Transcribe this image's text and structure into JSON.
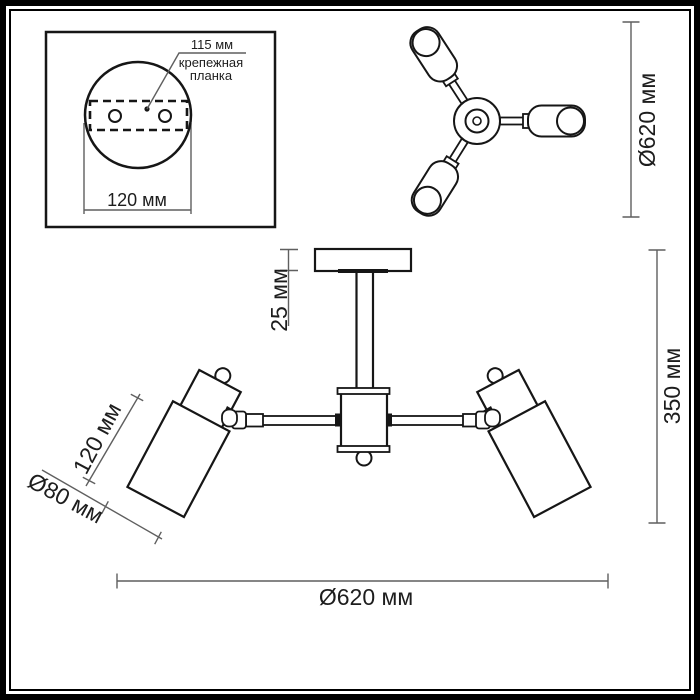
{
  "drawing": {
    "kind": "ceiling-lamp-dimension-drawing",
    "units": "мм"
  },
  "inset": {
    "plate_width_label": "115 мм",
    "plate_name_line1": "крепежная",
    "plate_name_line2": "планка",
    "base_diameter_label": "120 мм"
  },
  "top_view": {
    "overall_diameter_label": "Ø620 мм"
  },
  "side_view": {
    "canopy_height_label": "25 мм",
    "fixture_height_label": "350 мм",
    "shade_length_label": "120 мм",
    "shade_diameter_label": "Ø80 мм",
    "overall_diameter_label": "Ø620 мм"
  },
  "colors": {
    "line": "#161616",
    "dimension_line": "#5f5f5f",
    "background": "#ffffff",
    "frame": "#000000"
  }
}
